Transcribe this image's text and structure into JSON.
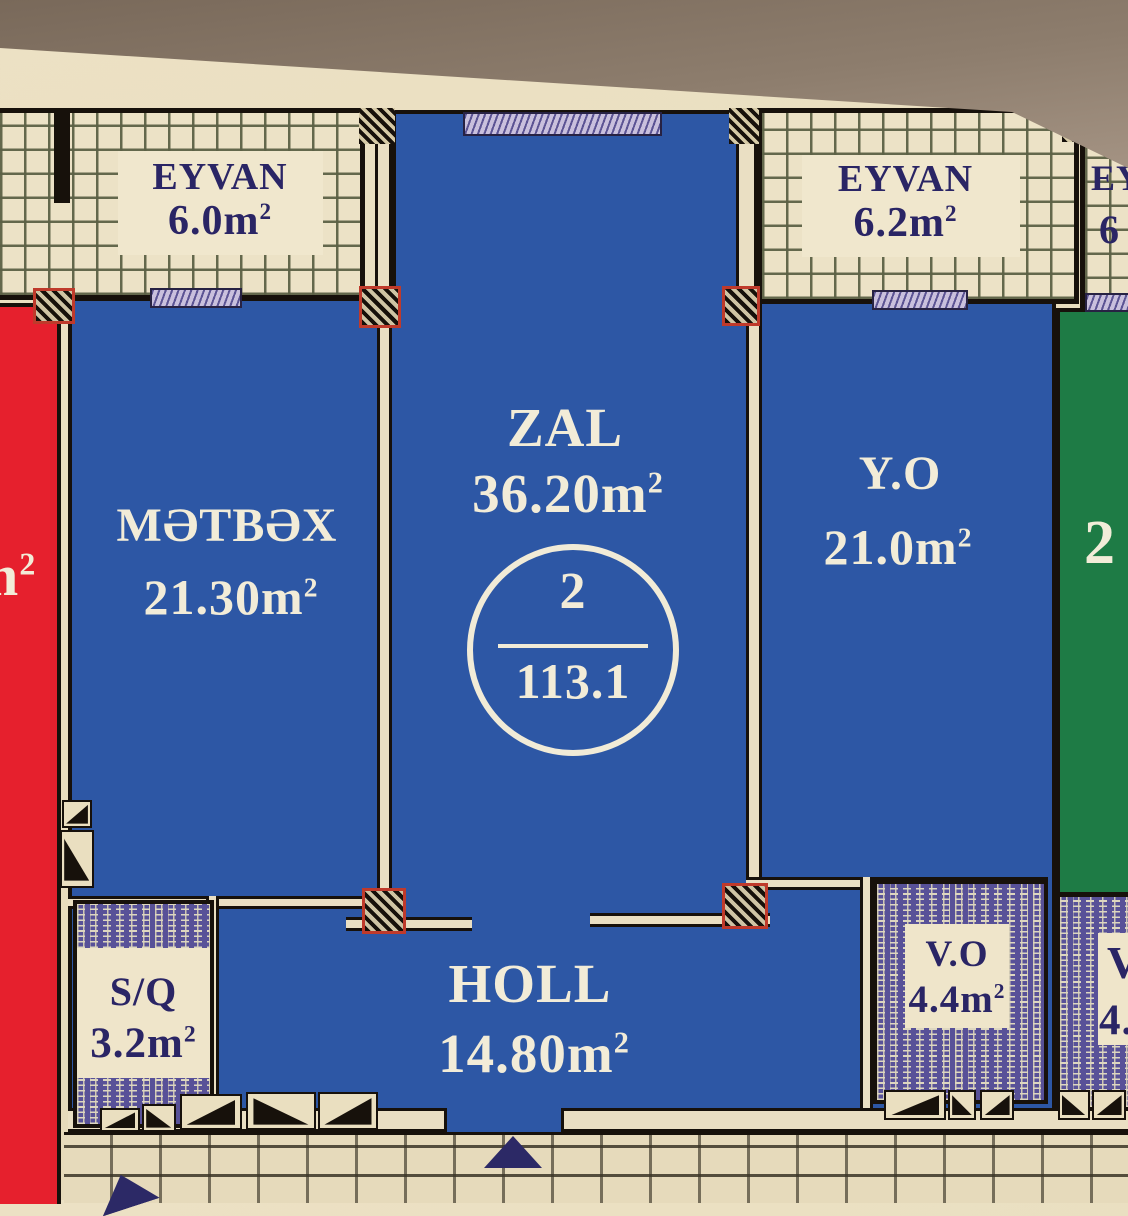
{
  "plan": {
    "unit_circle": {
      "number": "2",
      "total_area": "113.1"
    },
    "rooms": {
      "eyvan_left": {
        "label": "EYVAN",
        "area": "6.0m",
        "sup": "2"
      },
      "eyvan_right": {
        "label": "EYVAN",
        "area": "6.2m",
        "sup": "2"
      },
      "eyvan_far_right": {
        "label_partial": "EY",
        "area_partial": "6"
      },
      "metbex": {
        "label": "MƏTBƏX",
        "area": "21.30m",
        "sup": "2"
      },
      "zal": {
        "label": "ZAL",
        "area": "36.20m",
        "sup": "2"
      },
      "yo": {
        "label": "Y.O",
        "area": "21.0m",
        "sup": "2"
      },
      "green_partial": {
        "area_partial": "2"
      },
      "holl": {
        "label": "HOLL",
        "area": "14.80m",
        "sup": "2"
      },
      "sq": {
        "label": "S/Q",
        "area": "3.2m",
        "sup": "2"
      },
      "vo": {
        "label": "V.O",
        "area": "4.4m",
        "sup": "2"
      },
      "vo_far_right": {
        "label_partial": "V",
        "area_partial": "4."
      },
      "red_room_partial": {
        "area_partial": "m",
        "sup": "2"
      }
    },
    "colors": {
      "room_blue": "#2d57a5",
      "room_green": "#1e7b45",
      "room_red": "#e6202d",
      "paper_cream": "#e9debf",
      "wall_black": "#17110b",
      "pattern_purple": "#585198",
      "label_navy": "#2a2565",
      "label_pale": "#f2ecd8"
    }
  }
}
